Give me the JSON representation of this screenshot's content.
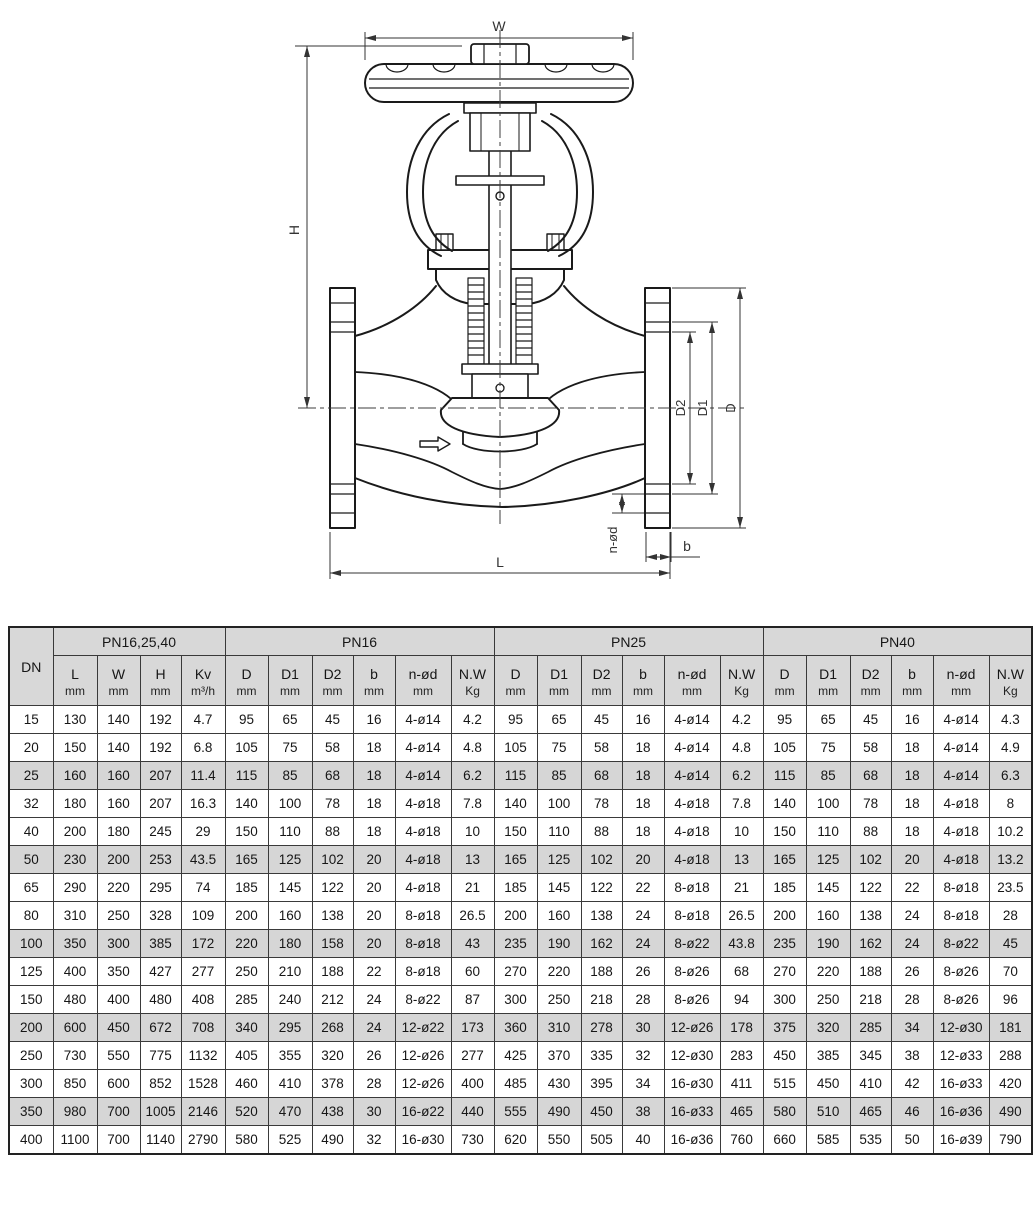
{
  "drawing": {
    "labels": {
      "W": "W",
      "H": "H",
      "L": "L",
      "D": "D",
      "D1": "D1",
      "D2": "D2",
      "n_od": "n-ød",
      "b": "b"
    }
  },
  "colors": {
    "header_bg": "#d8d8d8",
    "shaded_row_bg": "#d6d6d6",
    "table_border": "#222222",
    "drawing_line": "#1a1a1a"
  },
  "table": {
    "dn_header": "DN",
    "groups": [
      {
        "label": "PN16,25,40",
        "cols": [
          {
            "label": "L",
            "unit": "mm"
          },
          {
            "label": "W",
            "unit": "mm"
          },
          {
            "label": "H",
            "unit": "mm"
          },
          {
            "label": "Kv",
            "unit": "m³/h"
          }
        ]
      },
      {
        "label": "PN16",
        "cols": [
          {
            "label": "D",
            "unit": "mm"
          },
          {
            "label": "D1",
            "unit": "mm"
          },
          {
            "label": "D2",
            "unit": "mm"
          },
          {
            "label": "b",
            "unit": "mm"
          },
          {
            "label": "n-ød",
            "unit": "mm"
          },
          {
            "label": "N.W",
            "unit": "Kg"
          }
        ]
      },
      {
        "label": "PN25",
        "cols": [
          {
            "label": "D",
            "unit": "mm"
          },
          {
            "label": "D1",
            "unit": "mm"
          },
          {
            "label": "D2",
            "unit": "mm"
          },
          {
            "label": "b",
            "unit": "mm"
          },
          {
            "label": "n-ød",
            "unit": "mm"
          },
          {
            "label": "N.W",
            "unit": "Kg"
          }
        ]
      },
      {
        "label": "PN40",
        "cols": [
          {
            "label": "D",
            "unit": "mm"
          },
          {
            "label": "D1",
            "unit": "mm"
          },
          {
            "label": "D2",
            "unit": "mm"
          },
          {
            "label": "b",
            "unit": "mm"
          },
          {
            "label": "n-ød",
            "unit": "mm"
          },
          {
            "label": "N.W",
            "unit": "Kg"
          }
        ]
      }
    ],
    "rows": [
      {
        "dn": "15",
        "shaded": false,
        "cells": [
          "130",
          "140",
          "192",
          "4.7",
          "95",
          "65",
          "45",
          "16",
          "4-ø14",
          "4.2",
          "95",
          "65",
          "45",
          "16",
          "4-ø14",
          "4.2",
          "95",
          "65",
          "45",
          "16",
          "4-ø14",
          "4.3"
        ]
      },
      {
        "dn": "20",
        "shaded": false,
        "cells": [
          "150",
          "140",
          "192",
          "6.8",
          "105",
          "75",
          "58",
          "18",
          "4-ø14",
          "4.8",
          "105",
          "75",
          "58",
          "18",
          "4-ø14",
          "4.8",
          "105",
          "75",
          "58",
          "18",
          "4-ø14",
          "4.9"
        ]
      },
      {
        "dn": "25",
        "shaded": true,
        "cells": [
          "160",
          "160",
          "207",
          "11.4",
          "115",
          "85",
          "68",
          "18",
          "4-ø14",
          "6.2",
          "115",
          "85",
          "68",
          "18",
          "4-ø14",
          "6.2",
          "115",
          "85",
          "68",
          "18",
          "4-ø14",
          "6.3"
        ]
      },
      {
        "dn": "32",
        "shaded": false,
        "cells": [
          "180",
          "160",
          "207",
          "16.3",
          "140",
          "100",
          "78",
          "18",
          "4-ø18",
          "7.8",
          "140",
          "100",
          "78",
          "18",
          "4-ø18",
          "7.8",
          "140",
          "100",
          "78",
          "18",
          "4-ø18",
          "8"
        ]
      },
      {
        "dn": "40",
        "shaded": false,
        "cells": [
          "200",
          "180",
          "245",
          "29",
          "150",
          "110",
          "88",
          "18",
          "4-ø18",
          "10",
          "150",
          "110",
          "88",
          "18",
          "4-ø18",
          "10",
          "150",
          "110",
          "88",
          "18",
          "4-ø18",
          "10.2"
        ]
      },
      {
        "dn": "50",
        "shaded": true,
        "cells": [
          "230",
          "200",
          "253",
          "43.5",
          "165",
          "125",
          "102",
          "20",
          "4-ø18",
          "13",
          "165",
          "125",
          "102",
          "20",
          "4-ø18",
          "13",
          "165",
          "125",
          "102",
          "20",
          "4-ø18",
          "13.2"
        ]
      },
      {
        "dn": "65",
        "shaded": false,
        "cells": [
          "290",
          "220",
          "295",
          "74",
          "185",
          "145",
          "122",
          "20",
          "4-ø18",
          "21",
          "185",
          "145",
          "122",
          "22",
          "8-ø18",
          "21",
          "185",
          "145",
          "122",
          "22",
          "8-ø18",
          "23.5"
        ]
      },
      {
        "dn": "80",
        "shaded": false,
        "cells": [
          "310",
          "250",
          "328",
          "109",
          "200",
          "160",
          "138",
          "20",
          "8-ø18",
          "26.5",
          "200",
          "160",
          "138",
          "24",
          "8-ø18",
          "26.5",
          "200",
          "160",
          "138",
          "24",
          "8-ø18",
          "28"
        ]
      },
      {
        "dn": "100",
        "shaded": true,
        "cells": [
          "350",
          "300",
          "385",
          "172",
          "220",
          "180",
          "158",
          "20",
          "8-ø18",
          "43",
          "235",
          "190",
          "162",
          "24",
          "8-ø22",
          "43.8",
          "235",
          "190",
          "162",
          "24",
          "8-ø22",
          "45"
        ]
      },
      {
        "dn": "125",
        "shaded": false,
        "cells": [
          "400",
          "350",
          "427",
          "277",
          "250",
          "210",
          "188",
          "22",
          "8-ø18",
          "60",
          "270",
          "220",
          "188",
          "26",
          "8-ø26",
          "68",
          "270",
          "220",
          "188",
          "26",
          "8-ø26",
          "70"
        ]
      },
      {
        "dn": "150",
        "shaded": false,
        "cells": [
          "480",
          "400",
          "480",
          "408",
          "285",
          "240",
          "212",
          "24",
          "8-ø22",
          "87",
          "300",
          "250",
          "218",
          "28",
          "8-ø26",
          "94",
          "300",
          "250",
          "218",
          "28",
          "8-ø26",
          "96"
        ]
      },
      {
        "dn": "200",
        "shaded": true,
        "cells": [
          "600",
          "450",
          "672",
          "708",
          "340",
          "295",
          "268",
          "24",
          "12-ø22",
          "173",
          "360",
          "310",
          "278",
          "30",
          "12-ø26",
          "178",
          "375",
          "320",
          "285",
          "34",
          "12-ø30",
          "181"
        ]
      },
      {
        "dn": "250",
        "shaded": false,
        "cells": [
          "730",
          "550",
          "775",
          "1132",
          "405",
          "355",
          "320",
          "26",
          "12-ø26",
          "277",
          "425",
          "370",
          "335",
          "32",
          "12-ø30",
          "283",
          "450",
          "385",
          "345",
          "38",
          "12-ø33",
          "288"
        ]
      },
      {
        "dn": "300",
        "shaded": false,
        "cells": [
          "850",
          "600",
          "852",
          "1528",
          "460",
          "410",
          "378",
          "28",
          "12-ø26",
          "400",
          "485",
          "430",
          "395",
          "34",
          "16-ø30",
          "411",
          "515",
          "450",
          "410",
          "42",
          "16-ø33",
          "420"
        ]
      },
      {
        "dn": "350",
        "shaded": true,
        "cells": [
          "980",
          "700",
          "1005",
          "2146",
          "520",
          "470",
          "438",
          "30",
          "16-ø22",
          "440",
          "555",
          "490",
          "450",
          "38",
          "16-ø33",
          "465",
          "580",
          "510",
          "465",
          "46",
          "16-ø36",
          "490"
        ]
      },
      {
        "dn": "400",
        "shaded": false,
        "cells": [
          "1100",
          "700",
          "1140",
          "2790",
          "580",
          "525",
          "490",
          "32",
          "16-ø30",
          "730",
          "620",
          "550",
          "505",
          "40",
          "16-ø36",
          "760",
          "660",
          "585",
          "535",
          "50",
          "16-ø39",
          "790"
        ]
      }
    ]
  }
}
